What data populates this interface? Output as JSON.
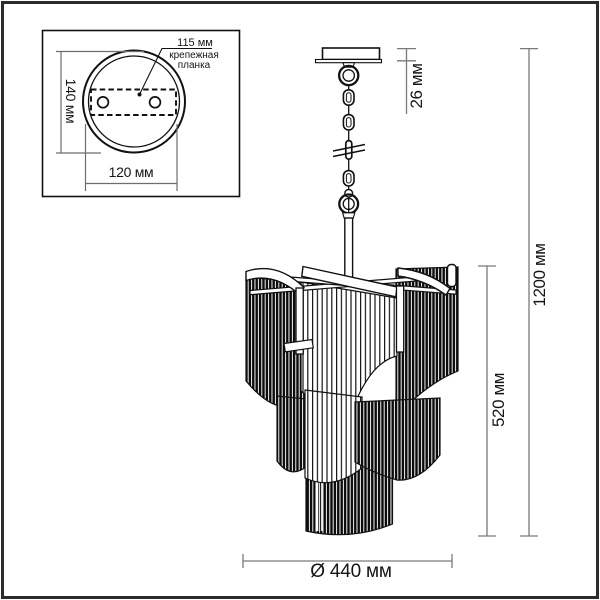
{
  "drawing": {
    "inset": {
      "plate_width": "115 мм",
      "plate_caption_line1": "крепежная",
      "plate_caption_line2": "планка",
      "base_height": "140 мм",
      "base_width": "120 мм"
    },
    "dimensions": {
      "canopy_height": "26 мм",
      "overall_height": "1200 мм",
      "shade_height": "520 мм",
      "diameter": "Ø 440 мм"
    },
    "colors": {
      "ink": "#111111",
      "dim_line": "#7a7a7a",
      "frame": "#2b2b2b",
      "background": "#ffffff"
    }
  }
}
